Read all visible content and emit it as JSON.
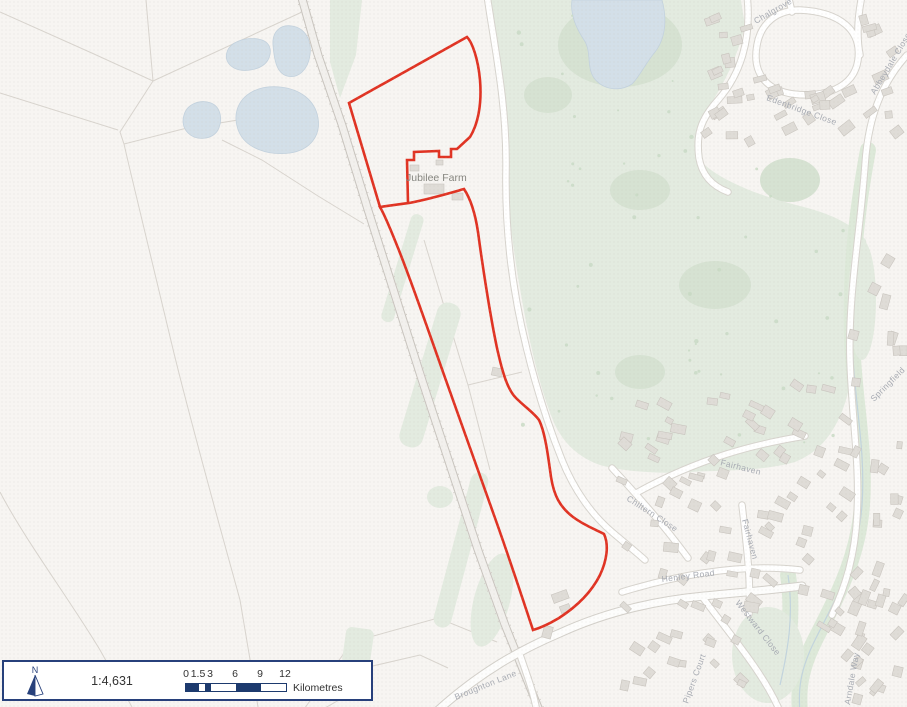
{
  "map": {
    "place_label": "Jubilee Farm",
    "labels": [
      {
        "id": "edenbridge",
        "text": "Edenbridge Close"
      },
      {
        "id": "abbeydale",
        "text": "Abbeydale Close"
      },
      {
        "id": "chalgrove",
        "text": "Chalgrove"
      },
      {
        "id": "fairhaven-1",
        "text": "Fairhaven"
      },
      {
        "id": "fairhaven-2",
        "text": "Fairhaven"
      },
      {
        "id": "chiltern",
        "text": "Chiltern Close"
      },
      {
        "id": "henley",
        "text": "Henley Road"
      },
      {
        "id": "westward",
        "text": "Westward Close"
      },
      {
        "id": "pipers",
        "text": "Pipers Court"
      },
      {
        "id": "arndale",
        "text": "Arndale Way"
      },
      {
        "id": "springfield",
        "text": "Springfield"
      },
      {
        "id": "broughton",
        "text": "Broughton Lane"
      }
    ]
  },
  "footer": {
    "north_label": "N",
    "scale_ratio": "1:4,631",
    "scale_ticks": [
      "0",
      "1.5",
      "3",
      "6",
      "9",
      "12"
    ],
    "scale_unit": "Kilometres"
  },
  "colors": {
    "site_boundary": "#e03323",
    "scalebar_fill": "#1d3a6e",
    "box_border": "#27407b",
    "green_area": "#e3ebe0",
    "water": "#d3dfe8"
  }
}
